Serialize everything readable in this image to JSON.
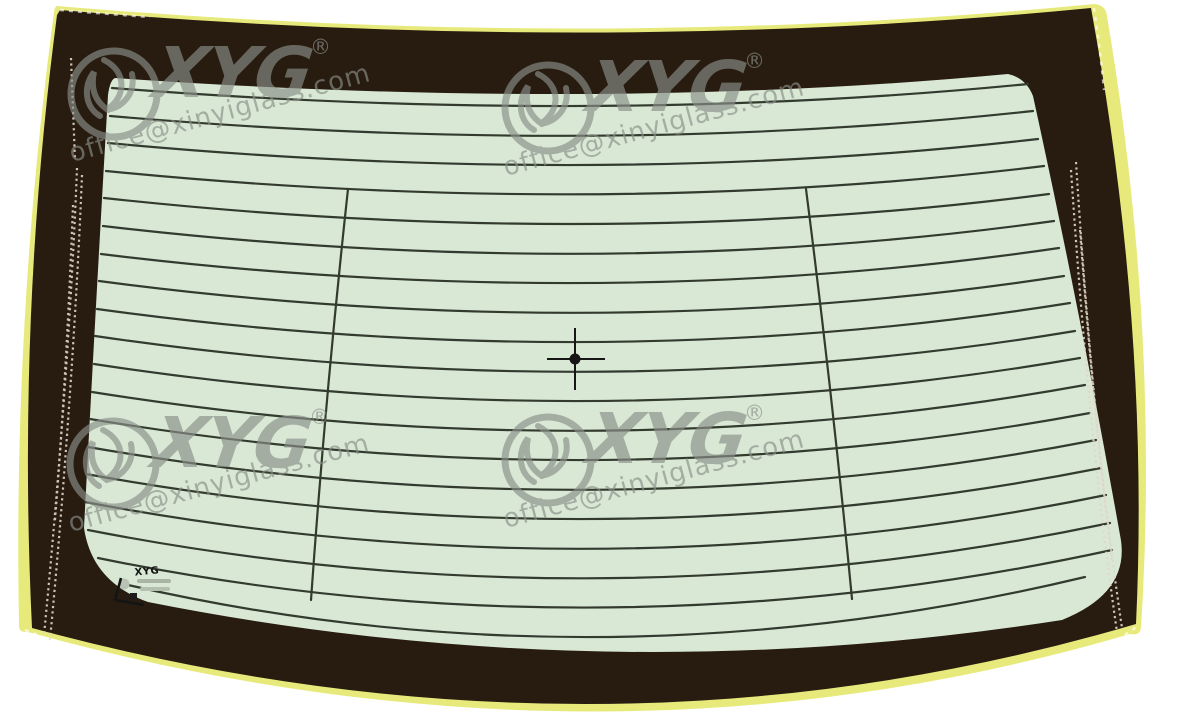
{
  "image_type": "rear-windshield-product-illustration",
  "watermark": {
    "brand": "XYG",
    "registered": "®",
    "email": "office@xinyiglass.com",
    "color": "#8a8f88"
  },
  "glass": {
    "tint_color": "#d9e8d5",
    "frit_color": "#281c10",
    "edge_color": "#e7ea7b",
    "defroster_line_color": "#333a2e",
    "defroster_line_count": 19
  },
  "stamp": {
    "brand": "XYG"
  }
}
